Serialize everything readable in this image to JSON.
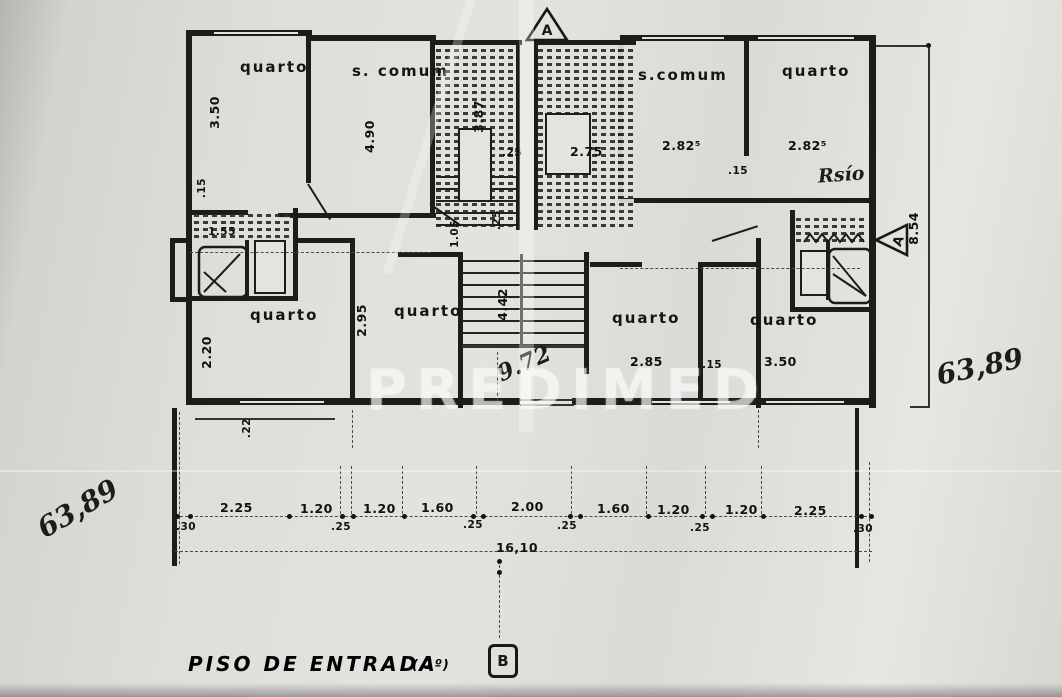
{
  "document": {
    "plan_title": "PISO DE ENTRADA",
    "plan_title_suffix": "( 1º)",
    "watermark": "PREDIMED"
  },
  "markers": {
    "section_top": "A",
    "section_side": "A",
    "section_bottom": "B"
  },
  "rooms": {
    "quarto_top_left": "quarto",
    "s_comum_left": "s. comum",
    "s_comum_right": "s.comum",
    "quarto_top_right": "quarto",
    "quarto_mid_left": "quarto",
    "quarto_mid_center": "quarto",
    "quarto_mid_right": "quarto",
    "quarto_mid_far_right": "quarto"
  },
  "dims": {
    "quarto_tl_width": "3.50",
    "wall_15_left": ".15",
    "s_comum_l_width": "4.90",
    "terrace_l_depth": "3.87",
    "gap_25_top": ".25",
    "terrace_c_width": "2.75",
    "s_comum_r_width": "2.82⁵",
    "quarto_tr_width": "2.82⁵",
    "wall_15_right": ".15",
    "building_depth": "8.54",
    "wc_width": "1.55",
    "hall_depth": "1.05",
    "hall_wall_25": ".25",
    "quarto_ml_depth": "2.20",
    "ledge_22": ".22",
    "quarto_mc_width": "2.95",
    "stair_length": "4.42",
    "quarto_mr_width": "2.85",
    "wall_15_mid": ".15",
    "quarto_fr_width": "3.50"
  },
  "handwritten": {
    "left_area_total": "63,89",
    "right_area_total": "63,89",
    "note_piso": "Rsío",
    "stair_run": "9.72"
  },
  "bottom_chain": {
    "segments": [
      ".30",
      "2.25",
      "1.20",
      ".25",
      "1.20",
      "1.60",
      ".25",
      "2.00",
      ".25",
      "1.60",
      "1.20",
      ".25",
      "1.20",
      "2.25",
      ".30"
    ],
    "total": "16,10"
  }
}
